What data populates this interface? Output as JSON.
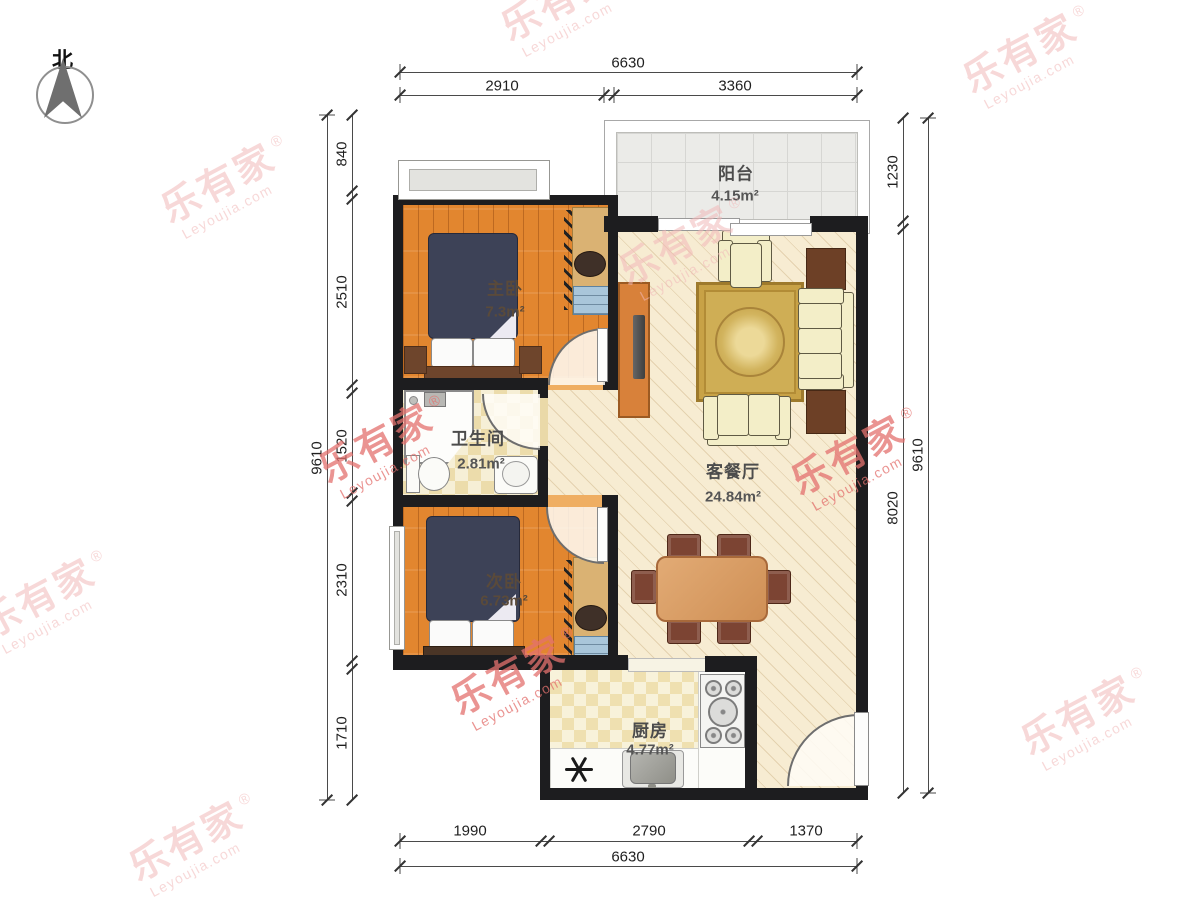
{
  "brand": {
    "cn": "乐有家",
    "en": "Leyoujia.com",
    "reg": "®"
  },
  "compass": {
    "north_label": "北"
  },
  "rooms": {
    "balcony": {
      "name": "阳台",
      "area": "4.15",
      "unit": "m²"
    },
    "master": {
      "name": "主卧",
      "area": "7.3",
      "unit": "m²"
    },
    "bathroom": {
      "name": "卫生间",
      "area": "2.81",
      "unit": "m²"
    },
    "second": {
      "name": "次卧",
      "area": "6.73",
      "unit": "m²"
    },
    "living": {
      "name": "客餐厅",
      "area": "24.84",
      "unit": "m²"
    },
    "kitchen": {
      "name": "厨房",
      "area": "4.77",
      "unit": "m²"
    }
  },
  "dimensions": {
    "top": {
      "total": "6630",
      "seg1": "2910",
      "seg2": "3360"
    },
    "bottom": {
      "total": "6630",
      "seg1": "1990",
      "seg2": "2790",
      "seg3": "1370"
    },
    "left": {
      "total": "9610",
      "seg1": "840",
      "seg2": "2510",
      "seg3": "1520",
      "seg4": "2310",
      "seg5": "1710"
    },
    "right": {
      "total": "9610",
      "seg1": "1230",
      "seg2": "8020"
    }
  },
  "colors": {
    "wall": "#1d1d1f",
    "wood_floor": "#e2862f",
    "living_floor": "#f7ecd2",
    "bath_tile": "#ecdcab",
    "bed": "#3d4257",
    "sofa": "#f3eec8",
    "dining_table": "#d99c64",
    "dining_chair": "#7c4433",
    "watermark_light": "#f2b9b9",
    "watermark_strong": "#e4716e"
  }
}
